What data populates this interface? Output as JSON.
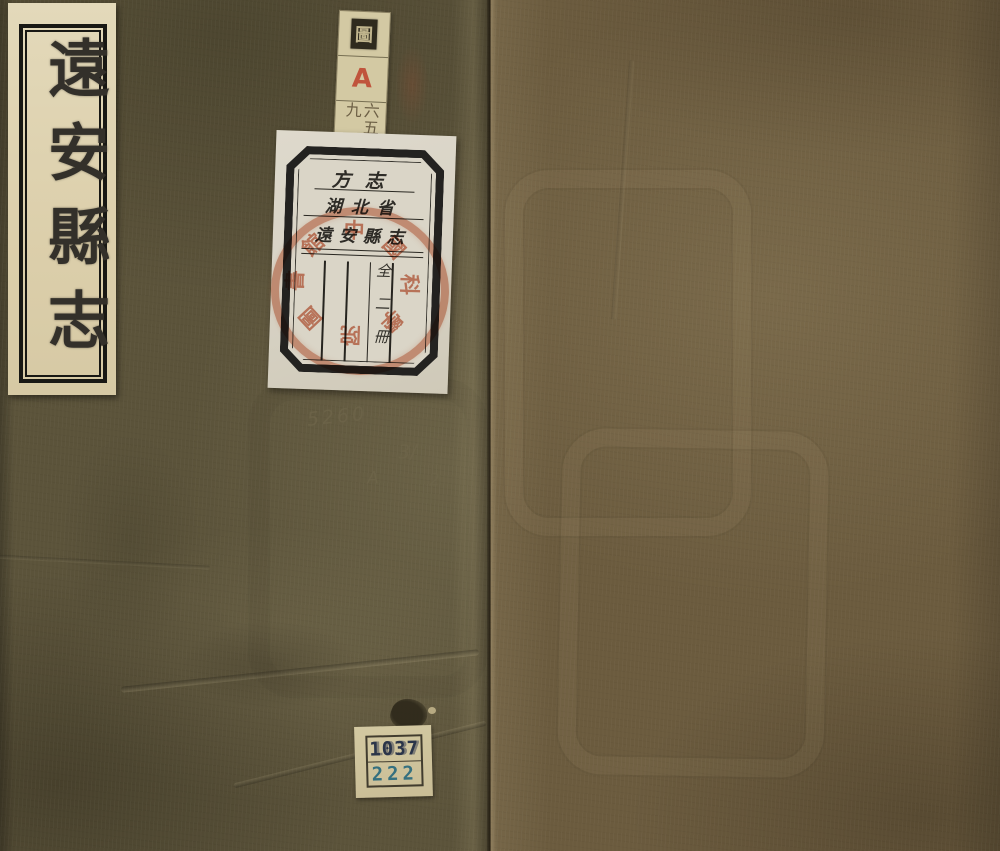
{
  "scene": {
    "description": "Photograph of a traditional Chinese thread-bound book cover, olive-brown cloth, with paper labels"
  },
  "cover": {
    "title": "遠安縣志",
    "left_cloth_color": "#5b533a",
    "right_cloth_color": "#6b5b3e",
    "title_slip_color": "#ddd2b0"
  },
  "call_strip": {
    "stamp": "圖",
    "letter": "A",
    "number": "六五九",
    "letter_color": "#c0543c"
  },
  "catalog_label": {
    "category": "方志",
    "province": "湖北省",
    "book_title": "遠安縣志",
    "volume_note": "全二冊",
    "seal_text": "中國科學院圖書館",
    "seal_color": "#cc6743",
    "paper_color": "#dad5c7"
  },
  "pencil_notes": {
    "line1": "5260",
    "line2": "3/",
    "line3": "A",
    "line4": "2"
  },
  "shelf_label": {
    "top_number": "1037",
    "bottom_number": "222",
    "top_color": "#2b3549",
    "bottom_color": "#35707f"
  }
}
